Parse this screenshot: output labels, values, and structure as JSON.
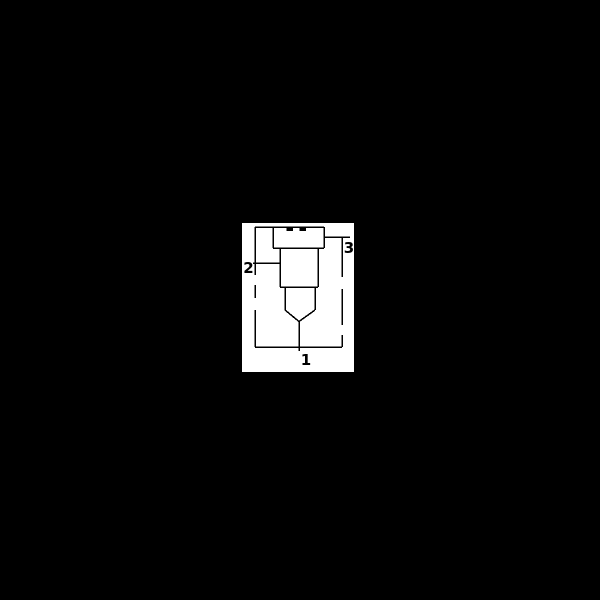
{
  "colors": {
    "screen_background": "#000000",
    "page_background": "#ffffff",
    "line_color": "#000000"
  },
  "diagram": {
    "kind": "cartridge-valve-outline-drawing",
    "ports": [
      {
        "id": "port-1",
        "label": "1",
        "position": "bottom"
      },
      {
        "id": "port-2",
        "label": "2",
        "position": "left"
      },
      {
        "id": "port-3",
        "label": "3",
        "position": "upper-right"
      }
    ]
  }
}
